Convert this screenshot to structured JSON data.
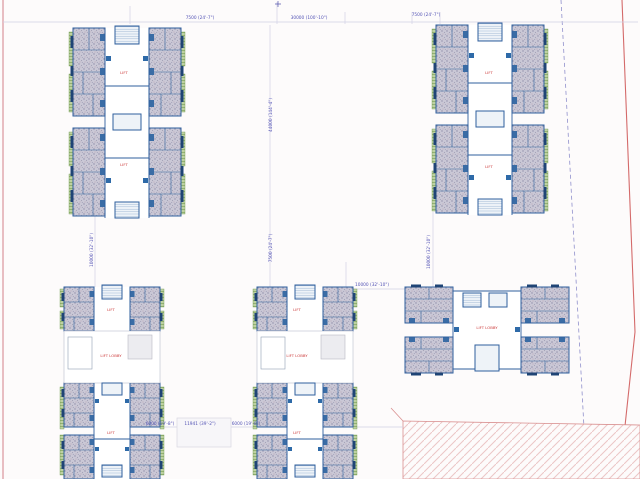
{
  "plan": {
    "dimensions": {
      "top_left": "7500 (24'-7\")",
      "top_center": "30000 (100'-10\")",
      "top_right": "7500 (24'-7\")",
      "center_vertical_upper": "44000 (144'-4\")",
      "center_vertical_lower": "7500 (24'-7\")",
      "left_vertical": "10000 (32'-10\")",
      "right_vertical": "10000 (32'-10\")",
      "mid_right_horizontal": "10000 (32'-10\")",
      "bottom_left": "6000 (19'-8\")",
      "bottom_middle": "11941 (39'-2\")",
      "bottom_right": "6000 (19'-8\")"
    },
    "labels": {
      "tower1_upper": "LIFT",
      "tower1_lower": "LIFT",
      "tower2_upper": "LIFT",
      "tower2_lower": "LIFT",
      "block1_upper": "LIFT",
      "block1_mid": "LIFT LOBBY",
      "block1_lower": "LIFT",
      "block2_upper": "LIFT",
      "block2_mid": "LIFT LOBBY",
      "block2_lower": "LIFT",
      "block3_center": "LIFT LOBBY"
    },
    "colors": {
      "boundary_red": "#d46a6a",
      "boundary_pink": "#dea3aa",
      "setback_dashed": "#9090cc",
      "wall_blue": "#2f5f9e",
      "wall_dark": "#1f4475",
      "dimension_text": "#5353b5",
      "unit_label_red": "#cc3b3b",
      "stipple_fill": "#cac8d6",
      "green_strip": "#bed1a2",
      "hatch_pink": "#ecc6c6"
    }
  }
}
